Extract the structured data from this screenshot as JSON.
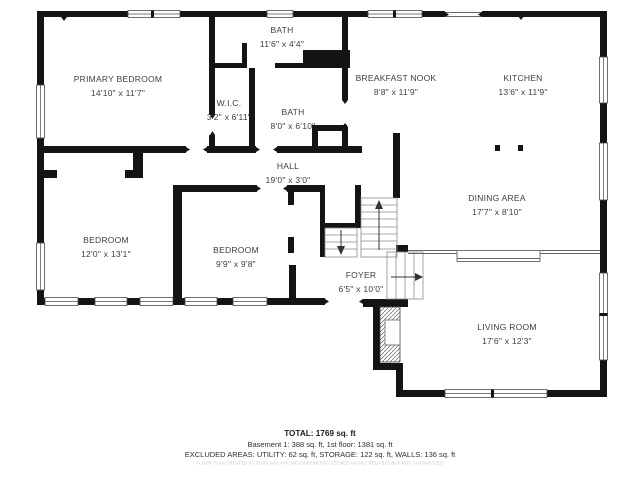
{
  "floor_plan": {
    "rooms": [
      {
        "name": "PRIMARY BEDROOM",
        "dims": "14'10\" x 11'7\""
      },
      {
        "name": "BATH",
        "dims": "11'6\" x 4'4\""
      },
      {
        "name": "W.I.C.",
        "dims": "3'2\" x 6'11\""
      },
      {
        "name": "BATH",
        "dims": "8'0\" x 6'10\""
      },
      {
        "name": "BREAKFAST NOOK",
        "dims": "8'8\" x 11'9\""
      },
      {
        "name": "KITCHEN",
        "dims": "13'6\" x 11'9\""
      },
      {
        "name": "HALL",
        "dims": "19'0\" x 3'0\""
      },
      {
        "name": "BEDROOM",
        "dims": "12'0\" x 13'1\""
      },
      {
        "name": "BEDROOM",
        "dims": "9'9\" x 9'8\""
      },
      {
        "name": "DINING AREA",
        "dims": "17'7\" x 8'10\""
      },
      {
        "name": "FOYER",
        "dims": "6'5\" x 10'0\""
      },
      {
        "name": "LIVING ROOM",
        "dims": "17'6\" x 12'3\""
      }
    ],
    "summary": {
      "total": "TOTAL: 1769 sq. ft",
      "floors": "Basement 1: 388 sq. ft, 1st floor: 1381 sq. ft",
      "excluded": "EXCLUDED AREAS: UTILITY: 62 sq. ft, STORAGE: 122 sq. ft, WALLS: 136 sq. ft",
      "disclaimer": "FLOOR PLAN CREATED BY CUBICASA APP. MEASUREMENTS DEEMED HIGHLY RELIABLE BUT NOT GUARANTEED"
    },
    "colors": {
      "wall": "#141414",
      "label": "#3d3d3d",
      "disclaimer": "#c5c5c5"
    }
  }
}
